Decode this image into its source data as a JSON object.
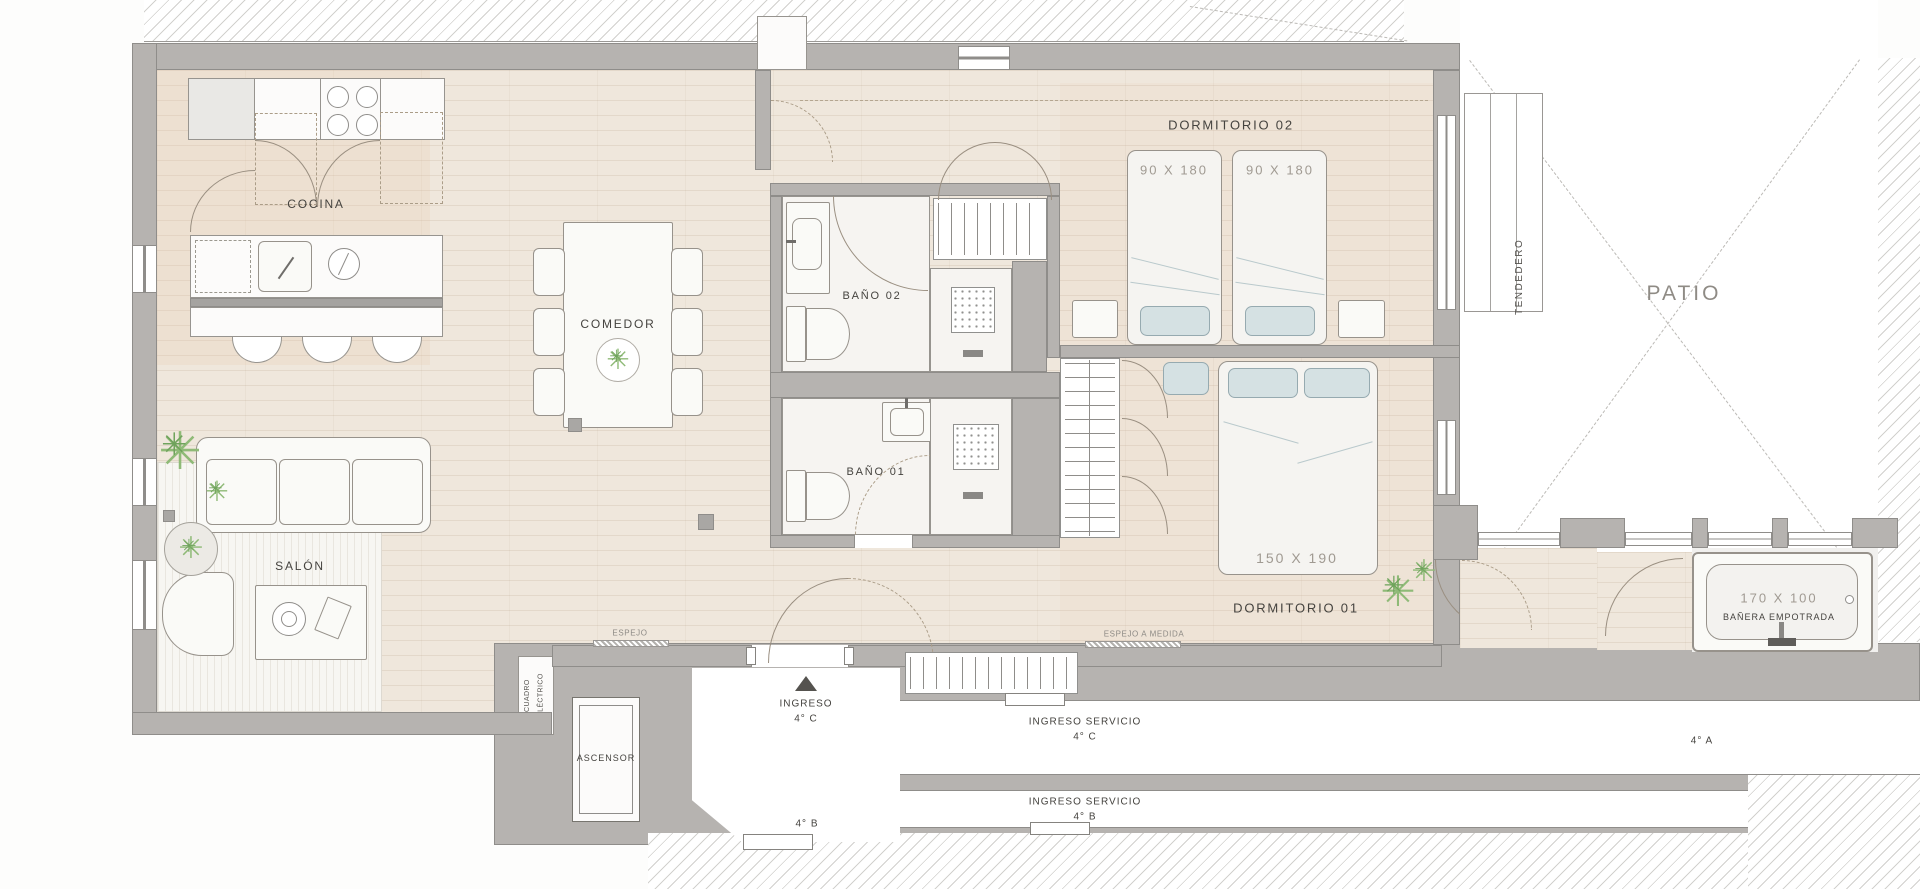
{
  "rooms": {
    "cocina": "COCINA",
    "comedor": "COMEDOR",
    "salon": "SALÓN",
    "bano02": "BAÑO 02",
    "bano01": "BAÑO 01",
    "dormitorio02": "DORMITORIO 02",
    "dormitorio01": "DORMITORIO 01",
    "ascensor": "ASCENSOR",
    "tendedero": "TENDEDERO",
    "patio": "PATIO",
    "cuadro_electrico": "CUADRO ELÉCTRICO"
  },
  "dims": {
    "bed_single_left": "90 X 180",
    "bed_single_right": "90 X 180",
    "bed_double": "150 X 190",
    "tub_size": "170 X 100",
    "tub_label": "BAÑERA EMPOTRADA"
  },
  "entry": {
    "main1": "INGRESO",
    "main2": "4° C",
    "serv_c1": "INGRESO SERVICIO",
    "serv_c2": "4° C",
    "serv_b1": "INGRESO SERVICIO",
    "serv_b2": "4° B",
    "apt_b": "4° B",
    "apt_a": "4° A"
  },
  "notes": {
    "espejo": "ESPEJO",
    "espejo_medida": "ESPEJO A MEDIDA"
  },
  "colors": {
    "wall": "#b6b3b0",
    "floor": "#efe7dc",
    "pillow_blue": "#d5e1e3",
    "plant_green": "#8fba77",
    "hatch_line": "#d2d1ce"
  }
}
